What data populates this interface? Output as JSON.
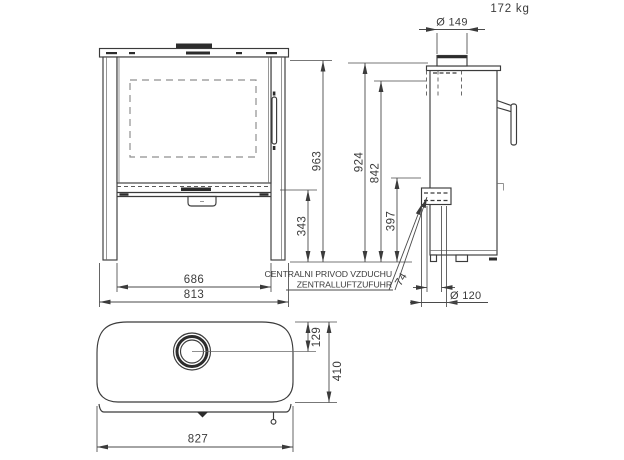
{
  "weight_label": "172 kg",
  "note": {
    "line1": "CENTRALNI PRIVOD VZDUCHU",
    "line2": "ZENTRALLUFTZUFUHR"
  },
  "dims": {
    "front": {
      "height_overall": "963",
      "plinth_height": "343",
      "body_width": "686",
      "width_overall": "813"
    },
    "side": {
      "flue_diameter": "Ø 149",
      "height_to_top": "924",
      "height_rear": "842",
      "inlet_height": "397",
      "inlet_offset": "74",
      "inlet_diameter": "Ø 120"
    },
    "top": {
      "flue_center_offset": "129",
      "depth_overall": "410",
      "width_overall": "827"
    }
  },
  "colors": {
    "line": "#3b3b3b",
    "background": "#ffffff"
  }
}
